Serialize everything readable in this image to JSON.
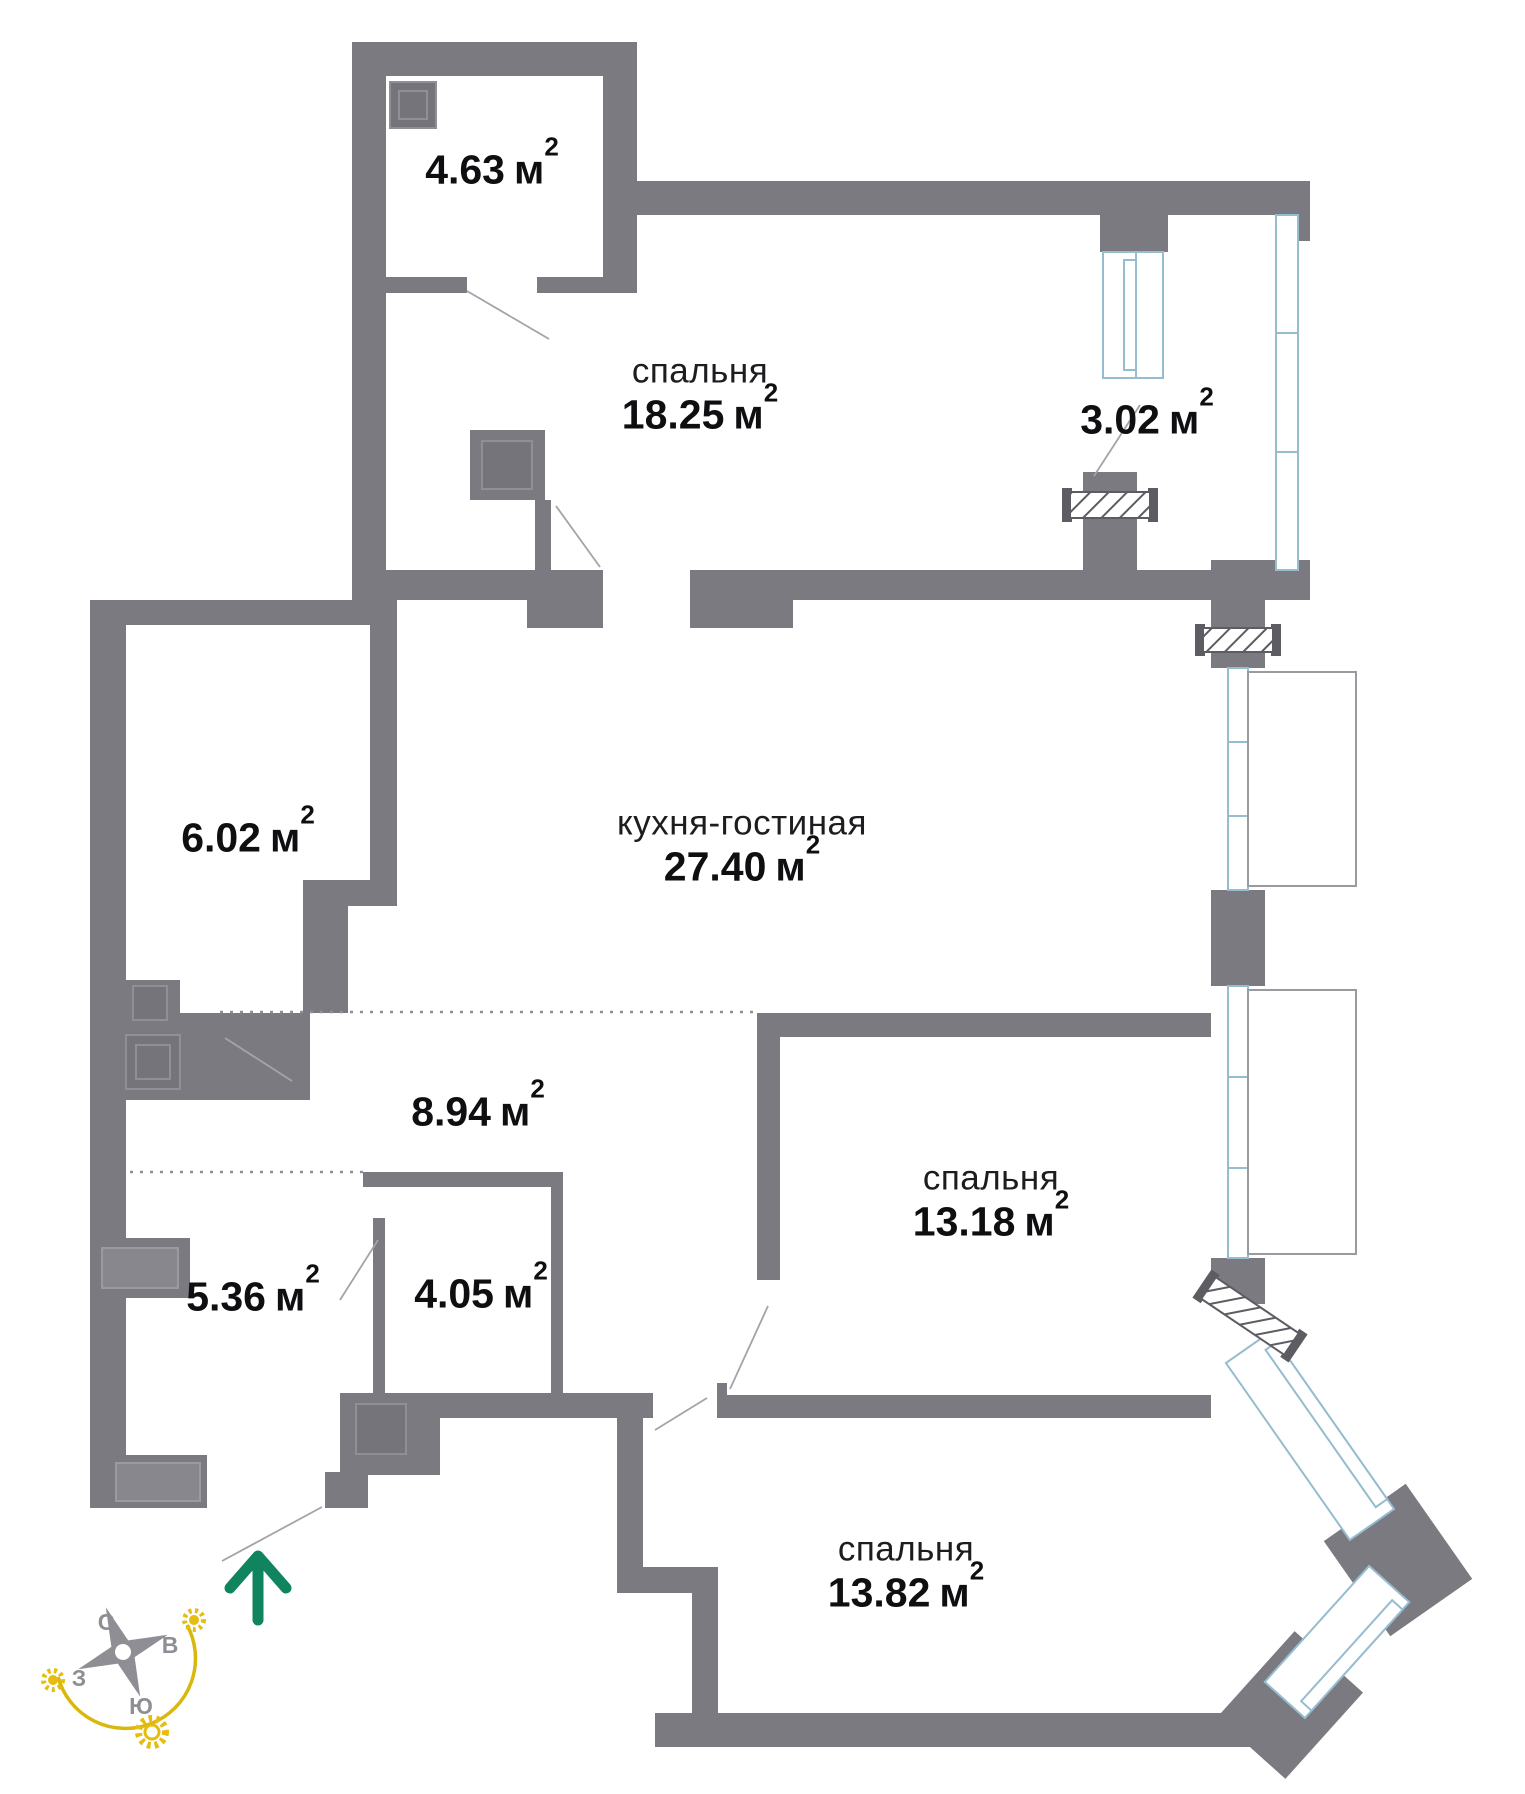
{
  "floorplan": {
    "rooms": [
      {
        "value": "4.63",
        "unit": "м",
        "sup": "2"
      },
      {
        "name": "спальня",
        "value": "18.25",
        "unit": "м",
        "sup": "2"
      },
      {
        "value": "3.02",
        "unit": "м",
        "sup": "2"
      },
      {
        "value": "6.02",
        "unit": "м",
        "sup": "2"
      },
      {
        "name": "кухня-гостиная",
        "value": "27.40",
        "unit": "м",
        "sup": "2"
      },
      {
        "value": "8.94",
        "unit": "м",
        "sup": "2"
      },
      {
        "name": "спальня",
        "value": "13.18",
        "unit": "м",
        "sup": "2"
      },
      {
        "value": "5.36",
        "unit": "м",
        "sup": "2"
      },
      {
        "value": "4.05",
        "unit": "м",
        "sup": "2"
      },
      {
        "name": "спальня",
        "value": "13.82",
        "unit": "м",
        "sup": "2"
      }
    ],
    "compass": {
      "north": "С",
      "east": "В",
      "west": "З",
      "south": "Ю"
    },
    "colors": {
      "wall": "#7A7A80",
      "window_frame": "#96BCD0",
      "entry_arrow": "#10845E",
      "compass_accent": "#D9B70D",
      "label_text": "#0F0F12"
    }
  }
}
